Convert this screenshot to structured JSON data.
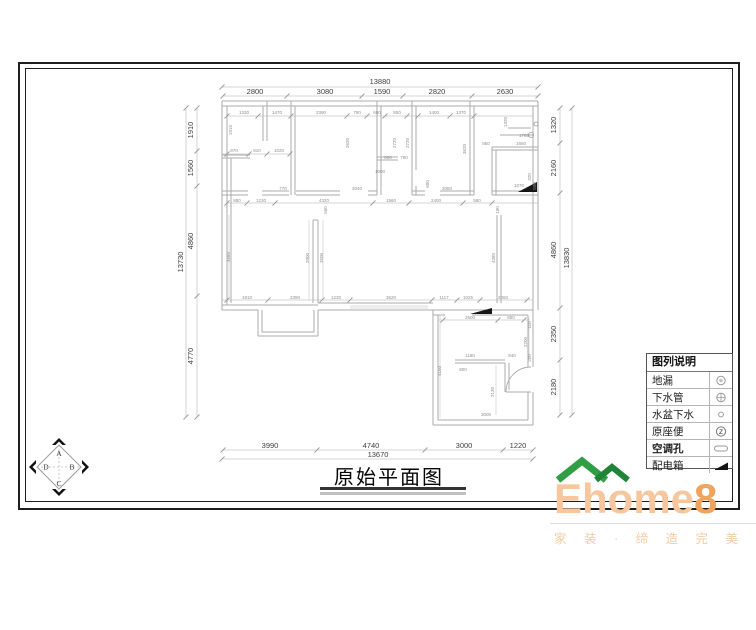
{
  "page": {
    "title": "原始平面图"
  },
  "compass": {
    "letters": [
      "A",
      "B",
      "C",
      "D"
    ]
  },
  "legend": {
    "header": "图列说明",
    "rows": [
      {
        "label": "地漏",
        "icon": "floor-drain-icon",
        "bold": false
      },
      {
        "label": "下水管",
        "icon": "drain-pipe-icon",
        "bold": false
      },
      {
        "label": "水盆下水",
        "icon": "basin-drain-icon",
        "bold": false
      },
      {
        "label": "原座便",
        "icon": "toilet-icon",
        "bold": false
      },
      {
        "label": "空调孔",
        "icon": "ac-hole-icon",
        "bold": true
      },
      {
        "label": "配电箱",
        "icon": "power-box-icon",
        "bold": false
      }
    ]
  },
  "logo": {
    "name_main": "Ehome",
    "name_digit": "8",
    "tagline": "家 装 · 缔 造 完 美 生 活",
    "roof_color": "#2f9e44",
    "roof_color_dark": "#1f8437",
    "text_color": "#f6c79e",
    "digit_color": "#f0a35c"
  },
  "plan": {
    "colors": {
      "wall": "#ababab",
      "thin": "#d2d2d2",
      "dim": "#c9c9c9",
      "tick": "#9a9a9a",
      "main_text": "#3d3d3d",
      "small_text": "#8f8f8f",
      "symbol": "#161616"
    },
    "dimensions": {
      "top": {
        "total": "13880",
        "segments": [
          "2800",
          "3080",
          "1590",
          "2820",
          "2630"
        ]
      },
      "bottom": {
        "total": "13670",
        "segments": [
          "3990",
          "4740",
          "3000",
          "1220"
        ]
      },
      "left": {
        "total": "13730",
        "segments": [
          "1910",
          "1560",
          "4860",
          "4770"
        ]
      },
      "right": {
        "total": "13830",
        "segments": [
          "1320",
          "2160",
          "4860",
          "2350",
          "2180"
        ]
      }
    },
    "dim_layout": {
      "top": {
        "mids": [
          255,
          325,
          382,
          437,
          505
        ],
        "label_y": 94,
        "total_pos": [
          380,
          84
        ]
      },
      "bottom": {
        "mids": [
          270,
          371,
          464,
          518
        ],
        "label_y": 448,
        "total_pos": [
          378,
          457
        ]
      },
      "left": {
        "mids": [
          130,
          168,
          241,
          356
        ],
        "label_x": 193,
        "total_pos": [
          183,
          262
        ]
      },
      "right": {
        "mids": [
          125,
          168,
          250,
          334,
          387
        ],
        "label_x": 556,
        "total_pos": [
          569,
          258
        ]
      }
    },
    "walls": [
      [
        222,
        101,
        538,
        101
      ],
      [
        222,
        106,
        538,
        106
      ],
      [
        222,
        101,
        222,
        310
      ],
      [
        227,
        106,
        227,
        305
      ],
      [
        538,
        101,
        538,
        310
      ],
      [
        533,
        106,
        533,
        310
      ],
      [
        222,
        305,
        258,
        305
      ],
      [
        222,
        310,
        258,
        310
      ],
      [
        258,
        305,
        318,
        305
      ],
      [
        258,
        310,
        258,
        336
      ],
      [
        318,
        310,
        318,
        336
      ],
      [
        258,
        336,
        318,
        336
      ],
      [
        262,
        332,
        314,
        332
      ],
      [
        262,
        310,
        262,
        332
      ],
      [
        314,
        310,
        314,
        332
      ],
      [
        318,
        303,
        433,
        303
      ],
      [
        318,
        310,
        433,
        310
      ],
      [
        433,
        310,
        533,
        310
      ],
      [
        433,
        310,
        433,
        425
      ],
      [
        438,
        315,
        438,
        420
      ],
      [
        433,
        425,
        533,
        425
      ],
      [
        438,
        420,
        528,
        420
      ],
      [
        533,
        310,
        533,
        367
      ],
      [
        528,
        315,
        528,
        367
      ],
      [
        533,
        392,
        533,
        425
      ],
      [
        528,
        392,
        528,
        420
      ],
      [
        433,
        315,
        445,
        315
      ],
      [
        472,
        315,
        528,
        315
      ],
      [
        455,
        360,
        505,
        360
      ],
      [
        455,
        363,
        505,
        363
      ],
      [
        505,
        363,
        505,
        392
      ],
      [
        509,
        363,
        509,
        390
      ],
      [
        506,
        392,
        531,
        392
      ],
      [
        267,
        101,
        267,
        141
      ],
      [
        263,
        106,
        263,
        141
      ],
      [
        222,
        155,
        250,
        155
      ],
      [
        222,
        158,
        250,
        158
      ],
      [
        231,
        158,
        231,
        303
      ],
      [
        222,
        191,
        248,
        191
      ],
      [
        222,
        195,
        248,
        195
      ],
      [
        262,
        191,
        289,
        191
      ],
      [
        262,
        195,
        289,
        195
      ],
      [
        291,
        101,
        291,
        195
      ],
      [
        295,
        106,
        295,
        195
      ],
      [
        296,
        191,
        340,
        191
      ],
      [
        296,
        195,
        340,
        195
      ],
      [
        368,
        191,
        377,
        191
      ],
      [
        368,
        195,
        377,
        195
      ],
      [
        377,
        101,
        377,
        195
      ],
      [
        381,
        106,
        381,
        195
      ],
      [
        377,
        157,
        398,
        157
      ],
      [
        377,
        160,
        398,
        160
      ],
      [
        412,
        101,
        412,
        195
      ],
      [
        416,
        106,
        416,
        170
      ],
      [
        416,
        186,
        416,
        195
      ],
      [
        412,
        191,
        425,
        191
      ],
      [
        440,
        191,
        474,
        191
      ],
      [
        412,
        195,
        425,
        195
      ],
      [
        440,
        195,
        474,
        195
      ],
      [
        470,
        101,
        470,
        195
      ],
      [
        474,
        106,
        474,
        195
      ],
      [
        492,
        147,
        492,
        195
      ],
      [
        496,
        150,
        496,
        195
      ],
      [
        492,
        147,
        538,
        147
      ],
      [
        492,
        150,
        538,
        150
      ],
      [
        492,
        191,
        538,
        191
      ],
      [
        492,
        195,
        538,
        195
      ],
      [
        500,
        135,
        533,
        135
      ],
      [
        508,
        128,
        531,
        128
      ],
      [
        313,
        220,
        313,
        303
      ],
      [
        318,
        220,
        318,
        303
      ],
      [
        313,
        220,
        318,
        220
      ],
      [
        497,
        215,
        497,
        303
      ],
      [
        501,
        215,
        501,
        303
      ]
    ],
    "thin_lines": [
      [
        350,
        306,
        428,
        306
      ],
      [
        350,
        308,
        428,
        308
      ],
      [
        309,
        220,
        309,
        300
      ],
      [
        323,
        220,
        323,
        300
      ],
      [
        440,
        315,
        440,
        418
      ],
      [
        496,
        365,
        496,
        415
      ],
      [
        529,
        318,
        529,
        360
      ],
      [
        229,
        215,
        229,
        300
      ]
    ],
    "dim_lines": [
      [
        222,
        87,
        538,
        87
      ],
      [
        222,
        96,
        538,
        96
      ],
      [
        222,
        450,
        533,
        450
      ],
      [
        222,
        459,
        533,
        459
      ],
      [
        186,
        108,
        186,
        417
      ],
      [
        197,
        108,
        197,
        417
      ],
      [
        560,
        108,
        560,
        415
      ],
      [
        572,
        108,
        572,
        415
      ],
      [
        227,
        203,
        538,
        203
      ],
      [
        222,
        300,
        533,
        300
      ],
      [
        227,
        116,
        533,
        116
      ],
      [
        222,
        154,
        291,
        154
      ],
      [
        438,
        320,
        528,
        320
      ]
    ],
    "ticks_h": [
      {
        "y": 87,
        "xs": [
          222,
          538
        ]
      },
      {
        "y": 96,
        "xs": [
          223,
          287,
          362,
          403,
          472,
          538
        ]
      },
      {
        "y": 450,
        "xs": [
          223,
          317,
          425,
          503,
          533
        ]
      },
      {
        "y": 459,
        "xs": [
          222,
          533
        ]
      },
      {
        "y": 203,
        "xs": [
          227,
          247,
          275,
          373,
          409,
          463,
          492
        ]
      },
      {
        "y": 300,
        "xs": [
          227,
          268,
          322,
          350,
          432,
          457,
          480,
          527
        ]
      },
      {
        "y": 320,
        "xs": [
          443,
          498,
          524
        ]
      },
      {
        "y": 116,
        "xs": [
          227,
          258,
          291,
          347,
          367,
          385,
          407,
          418,
          450,
          474
        ]
      },
      {
        "y": 154,
        "xs": [
          227,
          249,
          267,
          290
        ]
      }
    ],
    "ticks_v": [
      {
        "x": 186,
        "ys": [
          108,
          417
        ]
      },
      {
        "x": 197,
        "ys": [
          108,
          151,
          186,
          296,
          417
        ]
      },
      {
        "x": 560,
        "ys": [
          108,
          143,
          193,
          308,
          360,
          415
        ]
      },
      {
        "x": 572,
        "ys": [
          108,
          415
        ]
      }
    ],
    "arcs": [
      "M 506 392 A 25 25 0 0 1 531 367"
    ],
    "polys": [
      "518,192 537,182 537,192",
      "470,314 492,308 492,314"
    ],
    "circles": [
      [
        531,
        135,
        2.5
      ],
      [
        536,
        124,
        2
      ]
    ],
    "small_labels": [
      [
        "1330",
        244,
        114
      ],
      [
        "1470",
        277,
        114
      ],
      [
        "2390",
        321,
        114
      ],
      [
        "790",
        357,
        114
      ],
      [
        "600",
        377,
        114
      ],
      [
        "850",
        397,
        114
      ],
      [
        "1400",
        434,
        114
      ],
      [
        "1370",
        461,
        114
      ],
      [
        "970",
        234,
        152
      ],
      [
        "810",
        257,
        152
      ],
      [
        "1020",
        279,
        152
      ],
      [
        "800",
        388,
        159
      ],
      [
        "790",
        404,
        159
      ],
      [
        "1000",
        380,
        173
      ],
      [
        "770",
        283,
        190
      ],
      [
        "3040",
        357,
        190
      ],
      [
        "3080",
        447,
        190
      ],
      [
        "1070",
        519,
        187
      ],
      [
        "1780",
        524,
        137
      ],
      [
        "1650",
        521,
        145
      ],
      [
        "850",
        486,
        145
      ],
      [
        "880",
        237,
        202
      ],
      [
        "1230",
        261,
        202
      ],
      [
        "4320",
        324,
        202
      ],
      [
        "1560",
        391,
        202
      ],
      [
        "2400",
        436,
        202
      ],
      [
        "580",
        477,
        202
      ],
      [
        "1810",
        247,
        299
      ],
      [
        "2390",
        295,
        299
      ],
      [
        "1230",
        336,
        299
      ],
      [
        "3620",
        391,
        299
      ],
      [
        "1117",
        444,
        299
      ],
      [
        "1025",
        468,
        299
      ],
      [
        "2060",
        503,
        299
      ],
      [
        "2500",
        470,
        319
      ],
      [
        "850",
        511,
        319
      ],
      [
        "1180",
        470,
        357
      ],
      [
        "840",
        512,
        357
      ],
      [
        "800",
        463,
        371
      ],
      [
        "3000",
        486,
        416
      ]
    ],
    "small_labels_v": [
      [
        "1910",
        232,
        130
      ],
      [
        "2620",
        349,
        143
      ],
      [
        "2720",
        396,
        143
      ],
      [
        "2720",
        409,
        143
      ],
      [
        "3620",
        466,
        149
      ],
      [
        "1320",
        507,
        122
      ],
      [
        "320",
        531,
        177
      ],
      [
        "500",
        536,
        186
      ],
      [
        "560",
        327,
        210
      ],
      [
        "100",
        499,
        210
      ],
      [
        "4680",
        230,
        257
      ],
      [
        "2900",
        309,
        258
      ],
      [
        "3500",
        323,
        258
      ],
      [
        "4380",
        495,
        258
      ],
      [
        "600",
        429,
        184
      ],
      [
        "110",
        531,
        325
      ],
      [
        "2200",
        527,
        342
      ],
      [
        "220",
        531,
        358
      ],
      [
        "2130",
        494,
        392
      ],
      [
        "4150",
        441,
        371
      ]
    ]
  }
}
